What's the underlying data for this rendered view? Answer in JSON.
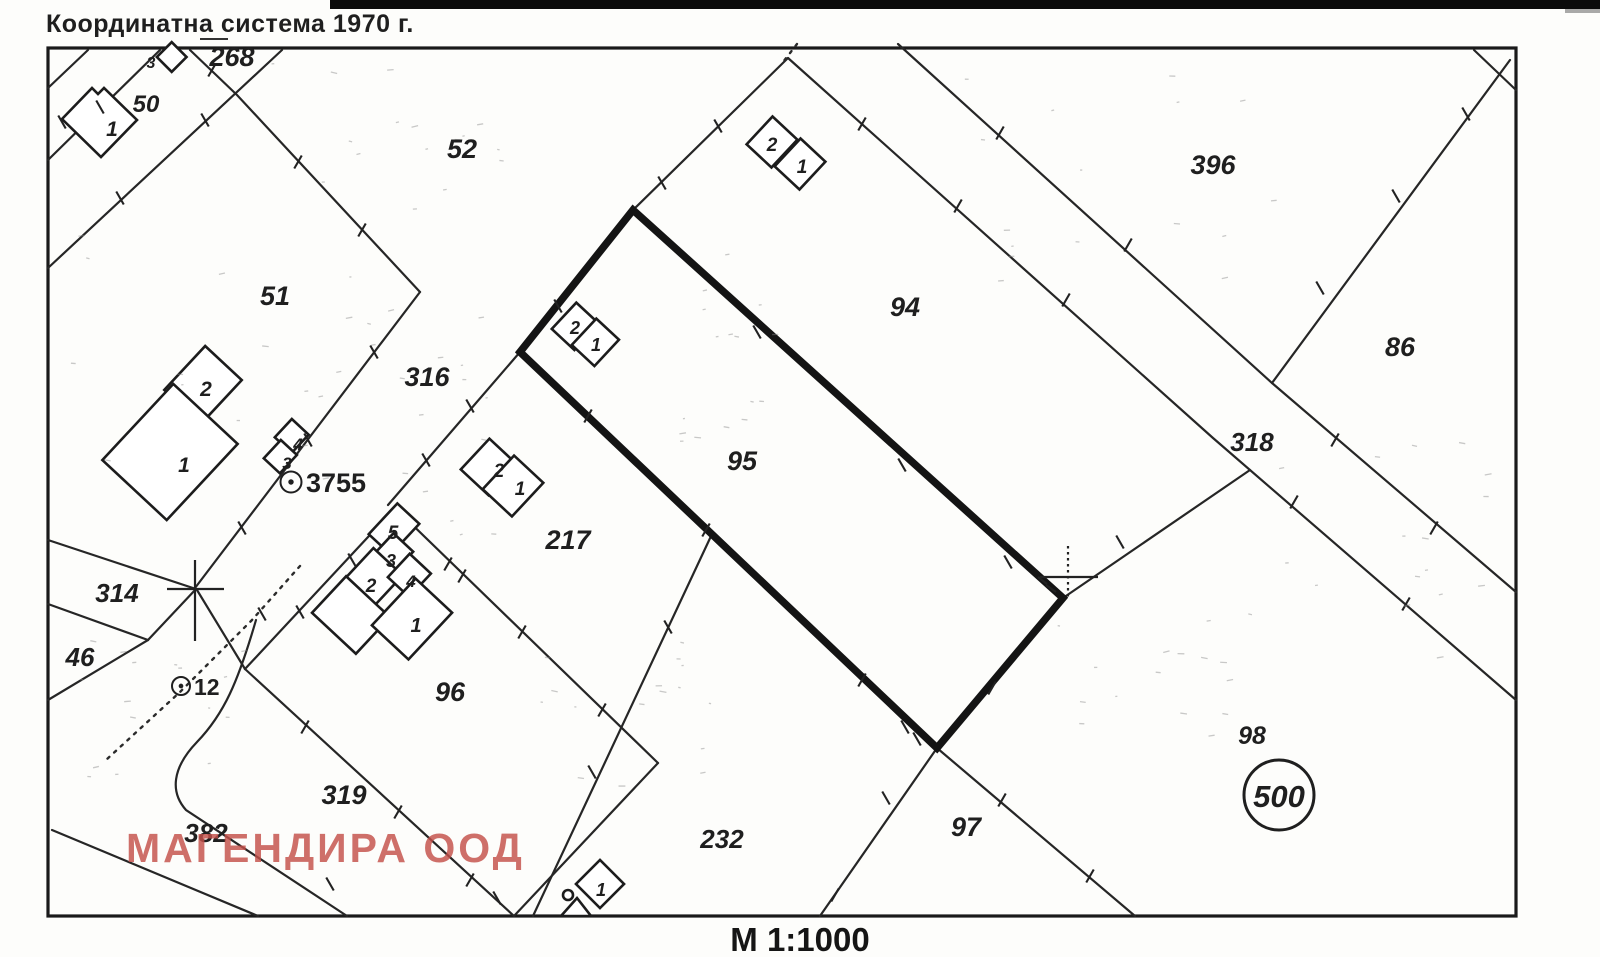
{
  "header": {
    "title": "Координатна система 1970 г."
  },
  "footer": {
    "scale_label": "М 1:1000"
  },
  "watermark": {
    "text": "МАГЕНДИРА ООД",
    "color": "#c4504a"
  },
  "colors": {
    "ink": "#1f1f1f",
    "bold_parcel_outline": "#141414",
    "paper": "#fdfdfb"
  },
  "map": {
    "parcel_labels": [
      {
        "text": "268",
        "x": 232,
        "y": 66,
        "size": 27
      },
      {
        "text": "50",
        "x": 146,
        "y": 112,
        "size": 24
      },
      {
        "text": "52",
        "x": 462,
        "y": 158,
        "size": 27
      },
      {
        "text": "51",
        "x": 275,
        "y": 305,
        "size": 27
      },
      {
        "text": "316",
        "x": 427,
        "y": 386,
        "size": 27
      },
      {
        "text": "396",
        "x": 1213,
        "y": 174,
        "size": 27
      },
      {
        "text": "94",
        "x": 905,
        "y": 316,
        "size": 27
      },
      {
        "text": "86",
        "x": 1400,
        "y": 356,
        "size": 27
      },
      {
        "text": "318",
        "x": 1252,
        "y": 451,
        "size": 26
      },
      {
        "text": "95",
        "x": 742,
        "y": 470,
        "size": 27
      },
      {
        "text": "217",
        "x": 568,
        "y": 549,
        "size": 27
      },
      {
        "text": "314",
        "x": 117,
        "y": 602,
        "size": 26
      },
      {
        "text": "46",
        "x": 80,
        "y": 666,
        "size": 26
      },
      {
        "text": "96",
        "x": 450,
        "y": 701,
        "size": 27
      },
      {
        "text": "319",
        "x": 344,
        "y": 804,
        "size": 27
      },
      {
        "text": "382",
        "x": 206,
        "y": 842,
        "size": 26
      },
      {
        "text": "232",
        "x": 722,
        "y": 848,
        "size": 26
      },
      {
        "text": "97",
        "x": 966,
        "y": 836,
        "size": 27
      },
      {
        "text": "98",
        "x": 1252,
        "y": 744,
        "size": 25
      }
    ],
    "building_labels": [
      {
        "text": "1",
        "x": 112,
        "y": 136,
        "size": 21
      },
      {
        "text": "2",
        "x": 206,
        "y": 396,
        "size": 21
      },
      {
        "text": "1",
        "x": 184,
        "y": 472,
        "size": 21
      },
      {
        "text": "4",
        "x": 298,
        "y": 450,
        "size": 17
      },
      {
        "text": "3",
        "x": 287,
        "y": 469,
        "size": 17
      },
      {
        "text": "2",
        "x": 575,
        "y": 334,
        "size": 18
      },
      {
        "text": "1",
        "x": 596,
        "y": 351,
        "size": 18
      },
      {
        "text": "2",
        "x": 772,
        "y": 151,
        "size": 19
      },
      {
        "text": "1",
        "x": 802,
        "y": 173,
        "size": 19
      },
      {
        "text": "2",
        "x": 499,
        "y": 477,
        "size": 19
      },
      {
        "text": "1",
        "x": 520,
        "y": 495,
        "size": 19
      },
      {
        "text": "5",
        "x": 393,
        "y": 539,
        "size": 19
      },
      {
        "text": "3",
        "x": 391,
        "y": 567,
        "size": 18
      },
      {
        "text": "2",
        "x": 371,
        "y": 592,
        "size": 19
      },
      {
        "text": "4",
        "x": 411,
        "y": 587,
        "size": 17
      },
      {
        "text": "1",
        "x": 416,
        "y": 632,
        "size": 20
      },
      {
        "text": "1",
        "x": 601,
        "y": 896,
        "size": 18
      },
      {
        "text": "3",
        "x": 151,
        "y": 68,
        "size": 16
      }
    ],
    "survey_points": [
      {
        "label": "3755",
        "cx": 291,
        "cy": 482,
        "r": 10.5,
        "tx": 306,
        "ty": 492,
        "size": 27
      },
      {
        "label": "12",
        "cx": 181,
        "cy": 686,
        "r": 9,
        "tx": 194,
        "ty": 695,
        "size": 23
      }
    ],
    "area_badge": {
      "text": "500",
      "cx": 1279,
      "cy": 795,
      "r": 35,
      "ty": 807,
      "size": 31
    }
  }
}
